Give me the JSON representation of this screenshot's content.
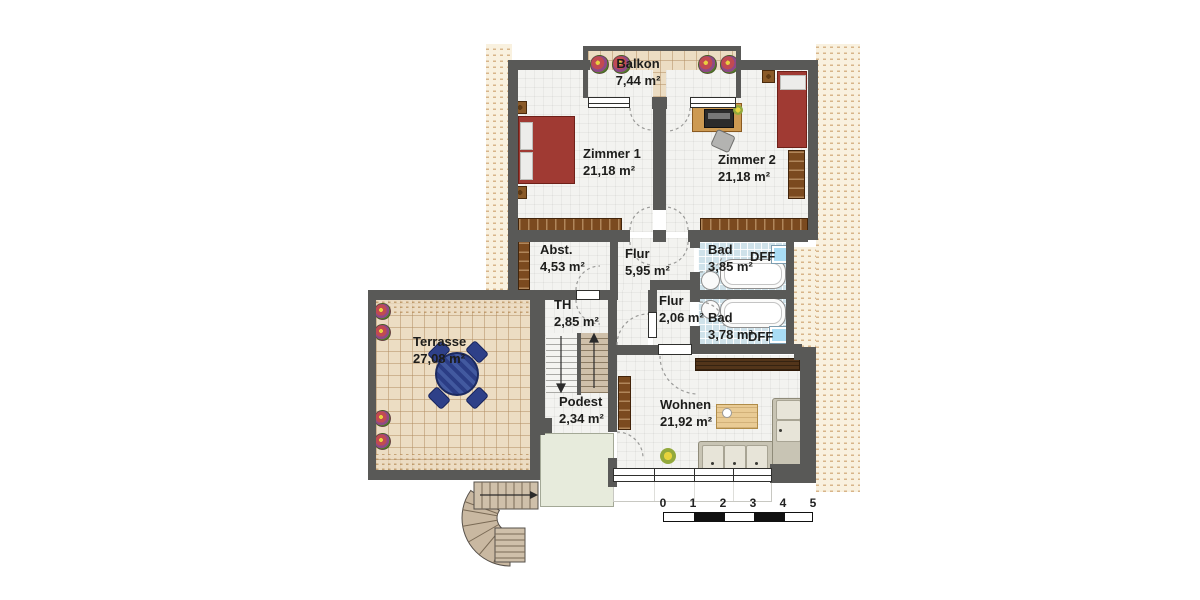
{
  "rooms": [
    {
      "id": "balkon",
      "name": "Balkon",
      "area": "7,44 m²"
    },
    {
      "id": "zimmer1",
      "name": "Zimmer 1",
      "area": "21,18 m²"
    },
    {
      "id": "zimmer2",
      "name": "Zimmer 2",
      "area": "21,18 m²"
    },
    {
      "id": "abstellraum",
      "name": "Abst.",
      "area": "4,53 m²"
    },
    {
      "id": "flur",
      "name": "Flur",
      "area": "5,95 m²"
    },
    {
      "id": "bad-oben",
      "name": "Bad",
      "area": "3,85 m²"
    },
    {
      "id": "treppenhaus",
      "name": "TH",
      "area": "2,85 m²"
    },
    {
      "id": "flur-2",
      "name": "Flur",
      "area": "2,06 m²"
    },
    {
      "id": "bad-unten",
      "name": "Bad",
      "area": "3,78 m²"
    },
    {
      "id": "terrasse",
      "name": "Terrasse",
      "area": "27,08 m²"
    },
    {
      "id": "podest",
      "name": "Podest",
      "area": "2,34 m²"
    },
    {
      "id": "wohnen",
      "name": "Wohnen",
      "area": "21,92 m²"
    }
  ],
  "skylights": {
    "label": "DFF"
  },
  "scale_bar": {
    "ticks": [
      "0",
      "1",
      "2",
      "3",
      "4",
      "5"
    ]
  },
  "colors": {
    "wall": "#595957",
    "roof_hatch": "#f9f1df",
    "hatch_dash": "#d8b58a",
    "room_floor": "#f3f3f0",
    "terrace_tile": "#ecddc3",
    "bath_tile": "#cfe2ea",
    "skylight_blue": "#a9dcf4",
    "bed_red": "#a03a33",
    "wood_brown": "#7b4a1f",
    "sofa_beige": "#c8c4b4",
    "terrace_table_blue": "#2b3d85",
    "green_area": "#e7ebdc"
  }
}
